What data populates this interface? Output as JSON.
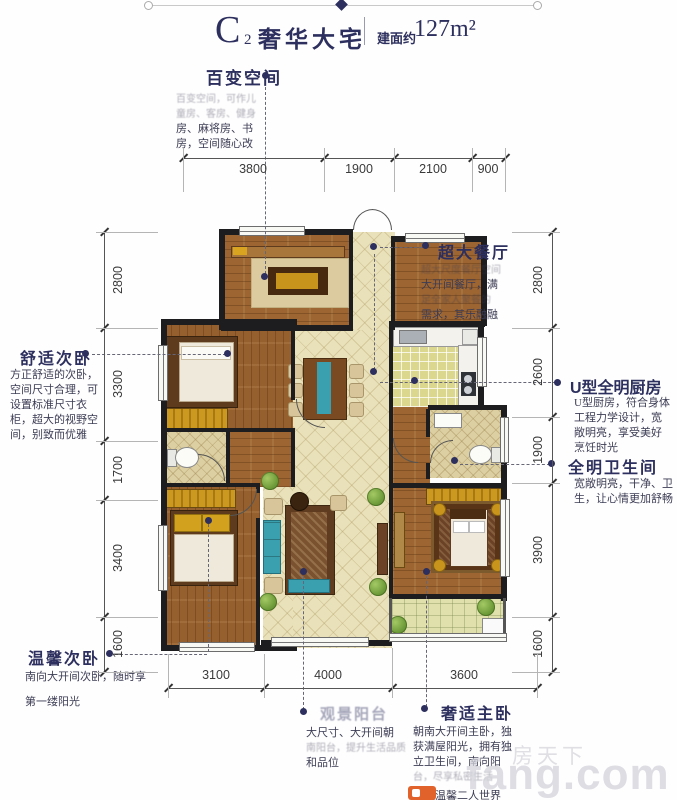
{
  "header": {
    "title_main": "C",
    "title_sub": "2",
    "title_name": "奢华大宅",
    "area_label": "建面约",
    "area_value": "127m²"
  },
  "annotations": {
    "versatile": {
      "heading": "百变空间",
      "lines": [
        "百变空间，可作儿",
        "童房、客房、健身",
        "房、麻将房、书",
        "房，空间随心改"
      ]
    },
    "dining": {
      "heading": "超大餐厅",
      "lines": [
        "超大尺度餐厅空间",
        "大开间餐厅，满",
        "足全家人聚餐的",
        "需求，其乐融融"
      ]
    },
    "kitchen": {
      "heading": "U型全明厨房",
      "lines": [
        "U型厨房，符合身体",
        "工程力学设计，宽",
        "敞明亮，享受美好",
        "烹饪时光"
      ]
    },
    "bathroom": {
      "heading": "全明卫生间",
      "lines": [
        "宽敞明亮，干净、卫",
        "生，让心情更加舒畅"
      ]
    },
    "bedroom2": {
      "heading": "舒适次卧",
      "lines": [
        "方正舒适的次卧，",
        "空间尺寸合理，可",
        "设置标准尺寸衣",
        "柜，超大的视野空",
        "间，别致而优雅"
      ]
    },
    "bedroom3": {
      "heading": "温馨次卧",
      "lines": [
        "南向大开间次卧，随时享",
        "第一缕阳光"
      ]
    },
    "balcony": {
      "heading": "观景阳台",
      "lines": [
        "大尺寸、大开间朝",
        "南阳台，提升生活品质",
        "和品位"
      ]
    },
    "master": {
      "heading": "奢适主卧",
      "lines": [
        "朝南大开间主卧，独",
        "获满屋阳光，拥有独",
        "立卫生间，南向阳",
        "台，尽享私密生活",
        "打造温馨二人世界"
      ]
    }
  },
  "dimensions": {
    "top": [
      "3800",
      "1900",
      "2100",
      "900"
    ],
    "left": [
      "2800",
      "3300",
      "1700",
      "3400",
      "1600"
    ],
    "right": [
      "2800",
      "2600",
      "1900",
      "3900",
      "1600"
    ],
    "bottom": [
      "3100",
      "4000",
      "3600"
    ]
  },
  "watermark": {
    "cn": "房天下",
    "en": "fang.com"
  },
  "colors": {
    "accent": "#2d2f5e",
    "wood": "#9c6531",
    "tile": "#e9e1ba",
    "gold": "#c8941c",
    "teal": "#3a9fae",
    "wall": "#1d1d1f"
  }
}
